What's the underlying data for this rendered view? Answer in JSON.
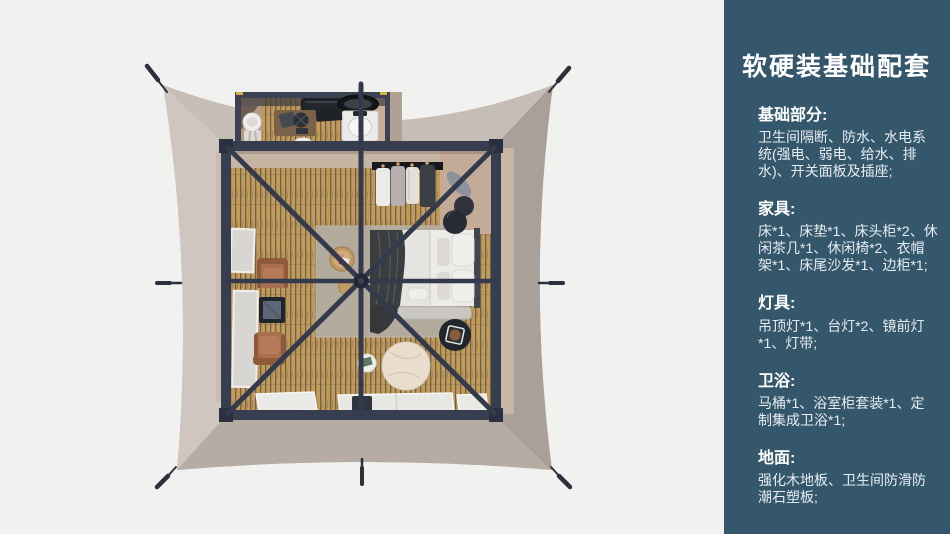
{
  "colors": {
    "sidebar_bg": "#35576C",
    "sidebar_text": "#FFFFFF",
    "sidebar_body": "#E7EDF1",
    "plan_bg": "#F1F1EF",
    "tent_canvas": "#C3BAB2",
    "tent_canvas_shadow": "#A9A09A",
    "room_frame": "#373E50",
    "wood_floor": "#C49A57",
    "interior_wall": "#C7B5A3"
  },
  "sidebar": {
    "title": "软硬装基础配套",
    "sections": [
      {
        "heading": "基础部分:",
        "body": "卫生间隔断、防水、水电系统(强电、弱电、给水、排水)、开关面板及插座;"
      },
      {
        "heading": "家具:",
        "body": "床*1、床垫*1、床头柜*2、休闲茶几*1、休闲椅*2、衣帽架*1、床尾沙发*1、边柜*1;"
      },
      {
        "heading": "灯具:",
        "body": "吊顶灯*1、台灯*2、镜前灯*1、灯带;"
      },
      {
        "heading": "卫浴:",
        "body": "马桶*1、浴室柜套装*1、定制集成卫浴*1;"
      },
      {
        "heading": "地面:",
        "body": "强化木地板、卫生间防滑防潮石塑板;"
      }
    ]
  }
}
